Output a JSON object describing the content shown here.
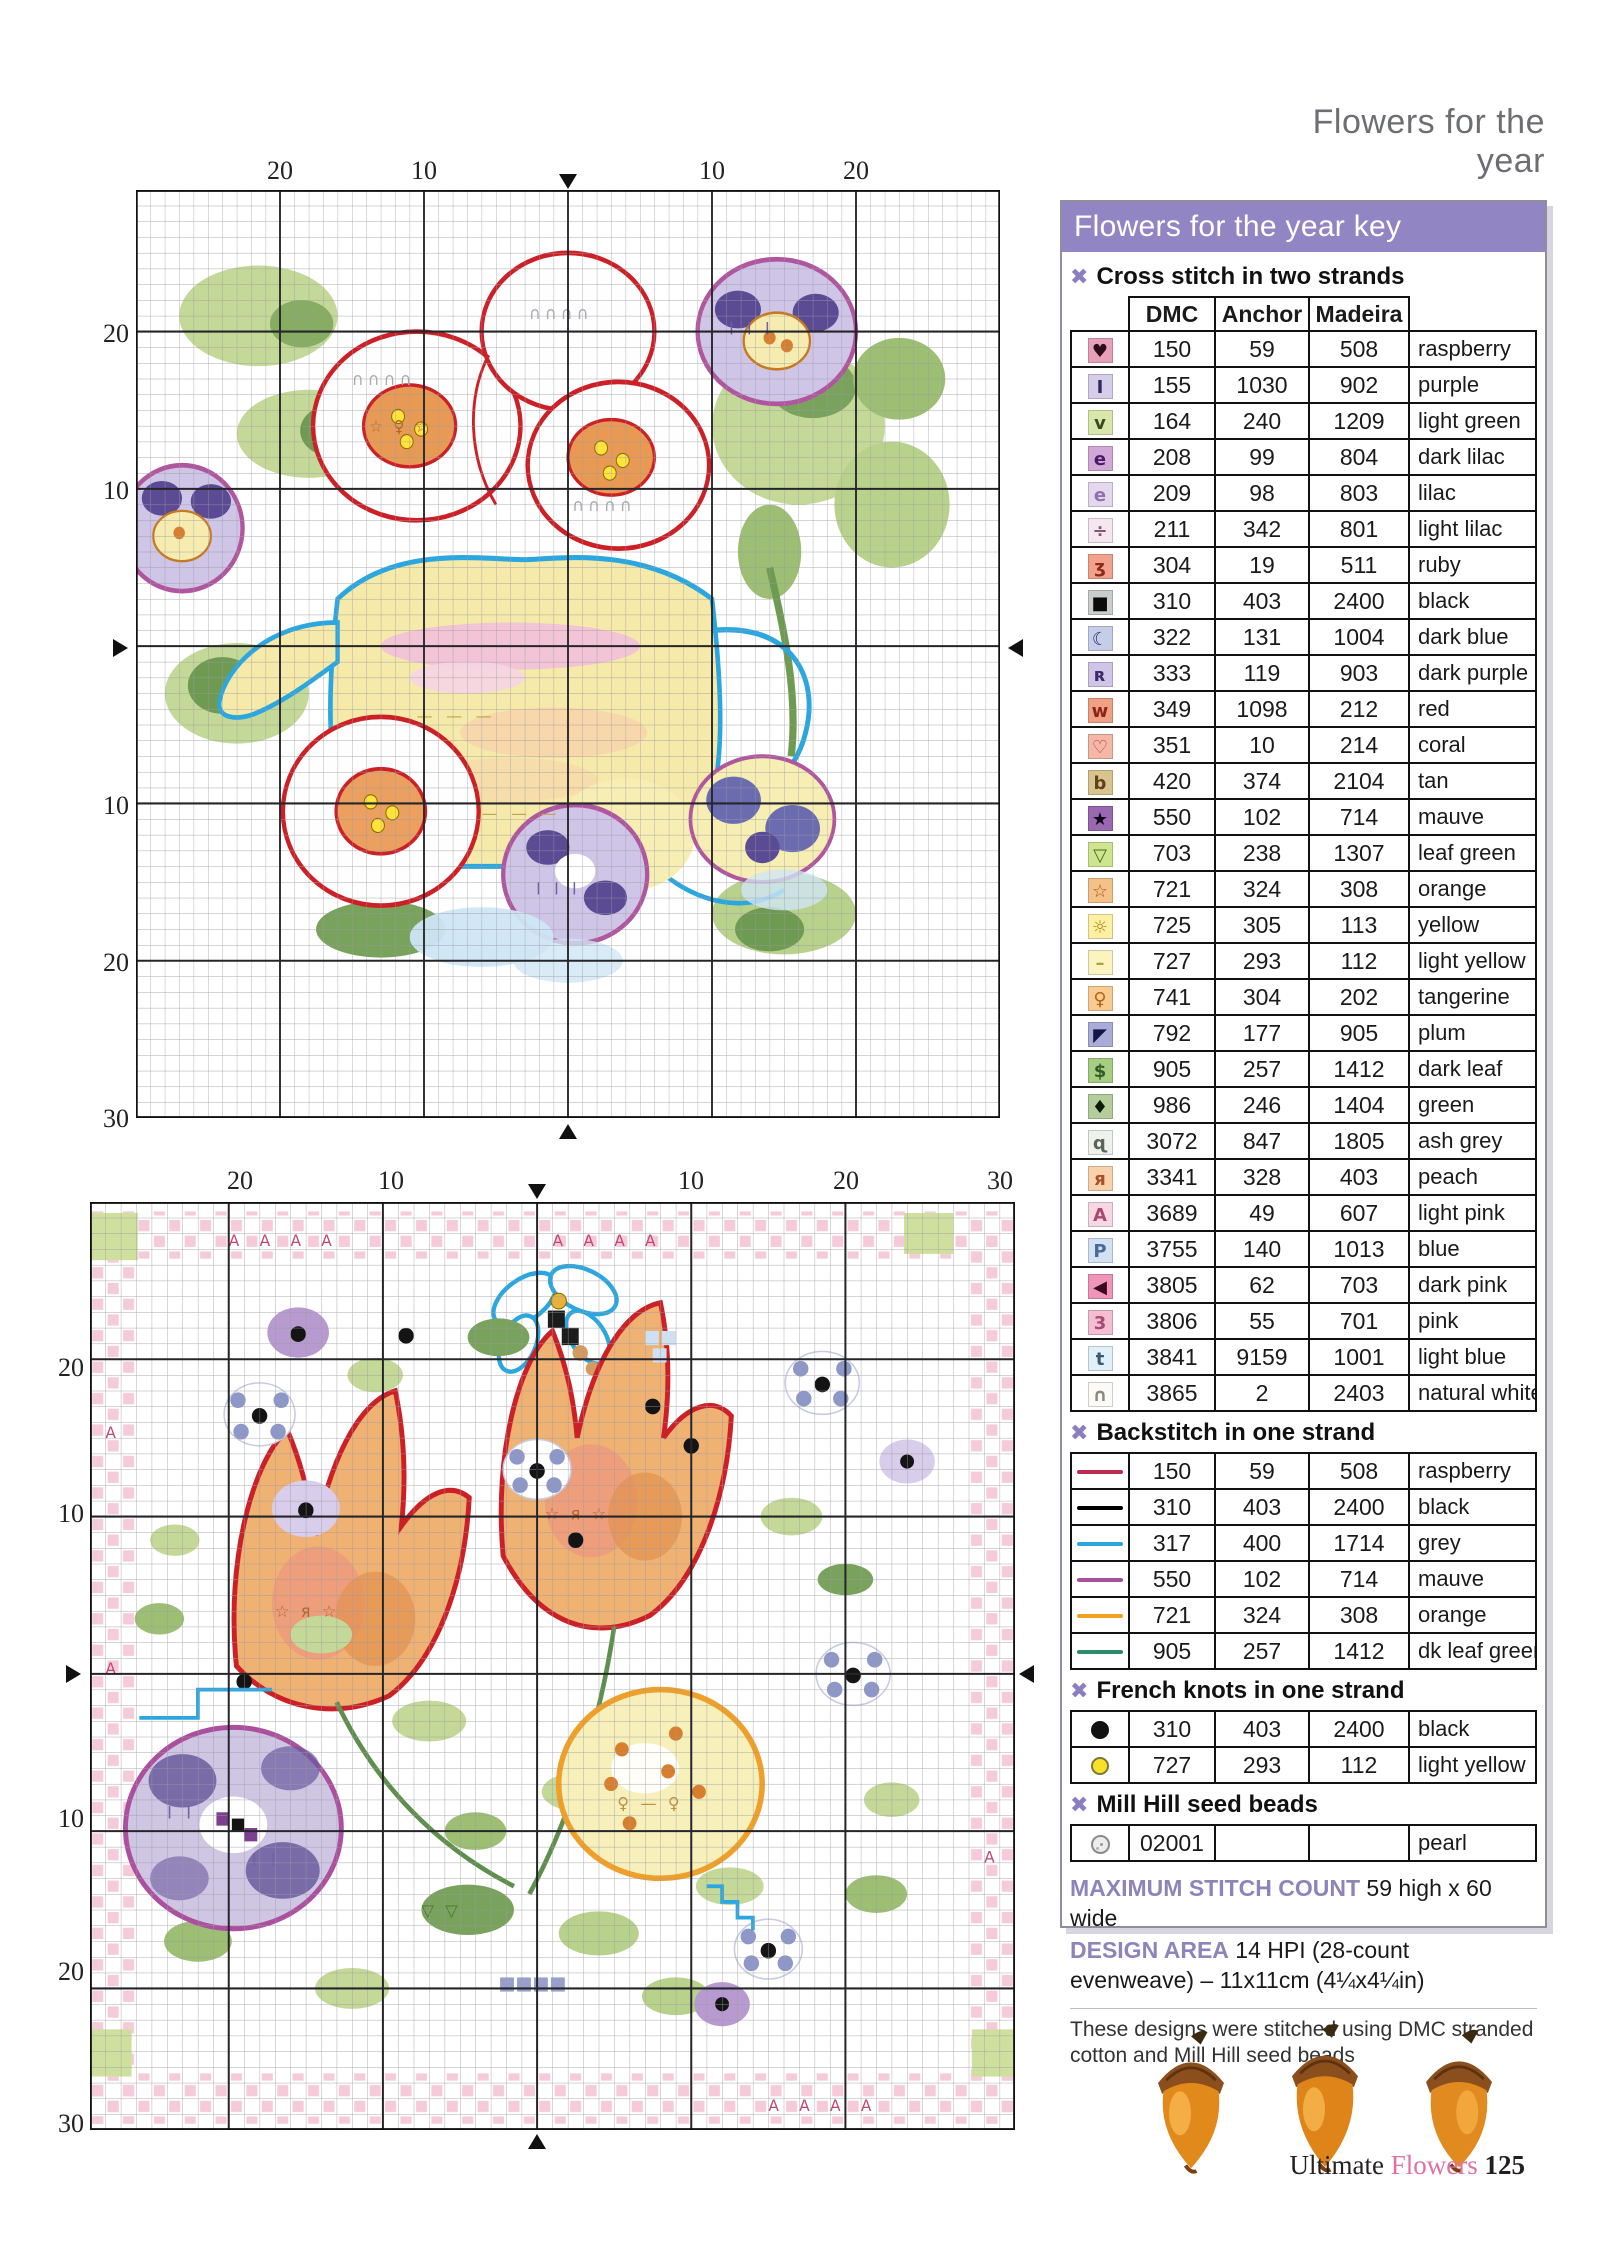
{
  "page": {
    "header": "Flowers for the year",
    "footer": {
      "brand": "Ultimate",
      "brand2": "Flowers",
      "page_number": "125"
    }
  },
  "charts": [
    {
      "name": "Teapot bouquet cross stitch chart",
      "top_labels": [
        "20",
        "10",
        "10",
        "20"
      ],
      "left_labels": [
        "20",
        "10",
        "10",
        "20",
        "30"
      ],
      "tex": {
        "white": "∩∩∩∩",
        "yellow": "— — —",
        "lilac": "I I I",
        "orange": "☆ ♀ ☆"
      }
    },
    {
      "name": "Tulip wreath cross stitch chart",
      "top_labels": [
        "20",
        "10",
        "10",
        "20",
        "30"
      ],
      "left_labels": [
        "20",
        "10",
        "10",
        "20",
        "30"
      ],
      "tex": {
        "borderA": "A   A   A   A",
        "singleA": "A",
        "lilac": "I I",
        "orange": "☆ я ☆",
        "yellow": "♀ — ♀",
        "green": "▽ ▽"
      }
    }
  ],
  "key": {
    "title": "Flowers for the year key",
    "sections": {
      "cross": {
        "label": "Cross stitch in two strands",
        "columns": [
          "DMC",
          "Anchor",
          "Madeira"
        ],
        "rows": [
          {
            "sym": "♥",
            "bg": "#e8a0b8",
            "fg": "#2a0d18",
            "dmc": "150",
            "anchor": "59",
            "madeira": "508",
            "name": "raspberry"
          },
          {
            "sym": "I",
            "bg": "#d6cdeb",
            "fg": "#2c2a5e",
            "dmc": "155",
            "anchor": "1030",
            "madeira": "902",
            "name": "purple"
          },
          {
            "sym": "v",
            "bg": "#d9e7ab",
            "fg": "#3a4a1e",
            "dmc": "164",
            "anchor": "240",
            "madeira": "1209",
            "name": "light green"
          },
          {
            "sym": "e",
            "bg": "#d2a8d8",
            "fg": "#4c1a64",
            "dmc": "208",
            "anchor": "99",
            "madeira": "804",
            "name": "dark lilac"
          },
          {
            "sym": "e",
            "bg": "#e4d7ee",
            "fg": "#8f6fae",
            "dmc": "209",
            "anchor": "98",
            "madeira": "803",
            "name": "lilac"
          },
          {
            "sym": "÷",
            "bg": "#f5e6f0",
            "fg": "#7c5a74",
            "dmc": "211",
            "anchor": "342",
            "madeira": "801",
            "name": "light lilac"
          },
          {
            "sym": "ʒ",
            "bg": "#f2a28c",
            "fg": "#8c2a1e",
            "dmc": "304",
            "anchor": "19",
            "madeira": "511",
            "name": "ruby"
          },
          {
            "sym": "■",
            "bg": "#cbcccc",
            "fg": "#0a0a0a",
            "dmc": "310",
            "anchor": "403",
            "madeira": "2400",
            "name": "black"
          },
          {
            "sym": "☾",
            "bg": "#c6cde9",
            "fg": "#23306e",
            "dmc": "322",
            "anchor": "131",
            "madeira": "1004",
            "name": "dark blue"
          },
          {
            "sym": "ʀ",
            "bg": "#d0c5e8",
            "fg": "#3a2a6e",
            "dmc": "333",
            "anchor": "119",
            "madeira": "903",
            "name": "dark purple"
          },
          {
            "sym": "w",
            "bg": "#f0a184",
            "fg": "#8c2418",
            "dmc": "349",
            "anchor": "1098",
            "madeira": "212",
            "name": "red"
          },
          {
            "sym": "♡",
            "bg": "#f5b8a8",
            "fg": "#b43a28",
            "dmc": "351",
            "anchor": "10",
            "madeira": "214",
            "name": "coral"
          },
          {
            "sym": "b",
            "bg": "#d9c48e",
            "fg": "#5e431a",
            "dmc": "420",
            "anchor": "374",
            "madeira": "2104",
            "name": "tan"
          },
          {
            "sym": "★",
            "bg": "#9a68b0",
            "fg": "#14061c",
            "dmc": "550",
            "anchor": "102",
            "madeira": "714",
            "name": "mauve"
          },
          {
            "sym": "▽",
            "bg": "#cfe48f",
            "fg": "#3f6d1f",
            "dmc": "703",
            "anchor": "238",
            "madeira": "1307",
            "name": "leaf green"
          },
          {
            "sym": "☆",
            "bg": "#f6c189",
            "fg": "#a05c14",
            "dmc": "721",
            "anchor": "324",
            "madeira": "308",
            "name": "orange"
          },
          {
            "sym": "☼",
            "bg": "#fdf0a2",
            "fg": "#b08818",
            "dmc": "725",
            "anchor": "305",
            "madeira": "113",
            "name": "yellow"
          },
          {
            "sym": "–",
            "bg": "#fbf4c0",
            "fg": "#b0a040",
            "dmc": "727",
            "anchor": "293",
            "madeira": "112",
            "name": "light yellow"
          },
          {
            "sym": "♀",
            "bg": "#f9cb90",
            "fg": "#b06414",
            "dmc": "741",
            "anchor": "304",
            "madeira": "202",
            "name": "tangerine"
          },
          {
            "sym": "◤",
            "bg": "#a9abd9",
            "fg": "#101848",
            "dmc": "792",
            "anchor": "177",
            "madeira": "905",
            "name": "plum"
          },
          {
            "sym": "$",
            "bg": "#a7cd83",
            "fg": "#2f5c24",
            "dmc": "905",
            "anchor": "257",
            "madeira": "1412",
            "name": "dark leaf"
          },
          {
            "sym": "♦",
            "bg": "#b3cd9d",
            "fg": "#0c1c08",
            "dmc": "986",
            "anchor": "246",
            "madeira": "1404",
            "name": "green"
          },
          {
            "sym": "ɋ",
            "bg": "#eef1ec",
            "fg": "#5a625a",
            "dmc": "3072",
            "anchor": "847",
            "madeira": "1805",
            "name": "ash grey"
          },
          {
            "sym": "я",
            "bg": "#f9d2ab",
            "fg": "#a8502c",
            "dmc": "3341",
            "anchor": "328",
            "madeira": "403",
            "name": "peach"
          },
          {
            "sym": "A",
            "bg": "#f7d7e4",
            "fg": "#a84a70",
            "dmc": "3689",
            "anchor": "49",
            "madeira": "607",
            "name": "light pink"
          },
          {
            "sym": "P",
            "bg": "#d2e1f3",
            "fg": "#4a6a96",
            "dmc": "3755",
            "anchor": "140",
            "madeira": "1013",
            "name": "blue"
          },
          {
            "sym": "◀",
            "bg": "#f094ba",
            "fg": "#3c0a20",
            "dmc": "3805",
            "anchor": "62",
            "madeira": "703",
            "name": "dark pink"
          },
          {
            "sym": "3",
            "bg": "#f5bdd2",
            "fg": "#a44a74",
            "dmc": "3806",
            "anchor": "55",
            "madeira": "701",
            "name": "pink"
          },
          {
            "sym": "t",
            "bg": "#e0eff8",
            "fg": "#3a5a72",
            "dmc": "3841",
            "anchor": "9159",
            "madeira": "1001",
            "name": "light blue"
          },
          {
            "sym": "∩",
            "bg": "#fbfaf6",
            "fg": "#8a8a82",
            "dmc": "3865",
            "anchor": "2",
            "madeira": "2403",
            "name": "natural white"
          }
        ]
      },
      "backstitch": {
        "label": "Backstitch in one strand",
        "rows": [
          {
            "line": "#c22950",
            "dmc": "150",
            "anchor": "59",
            "madeira": "508",
            "name": "raspberry"
          },
          {
            "line": "#000000",
            "dmc": "310",
            "anchor": "403",
            "madeira": "2400",
            "name": "black"
          },
          {
            "line": "#2ba6de",
            "dmc": "317",
            "anchor": "400",
            "madeira": "1714",
            "name": "grey"
          },
          {
            "line": "#a4509b",
            "dmc": "550",
            "anchor": "102",
            "madeira": "714",
            "name": "mauve"
          },
          {
            "line": "#f5a01e",
            "dmc": "721",
            "anchor": "324",
            "madeira": "308",
            "name": "orange"
          },
          {
            "line": "#2e8b6e",
            "dmc": "905",
            "anchor": "257",
            "madeira": "1412",
            "name": "dk leaf green"
          }
        ]
      },
      "french": {
        "label": "French knots in one strand",
        "rows": [
          {
            "color": "#111111",
            "ring": "#111111",
            "dmc": "310",
            "anchor": "403",
            "madeira": "2400",
            "name": "black"
          },
          {
            "color": "#f8e229",
            "ring": "#7a7a38",
            "dmc": "727",
            "anchor": "293",
            "madeira": "112",
            "name": "light yellow"
          }
        ]
      },
      "beads": {
        "label": "Mill Hill seed beads",
        "rows": [
          {
            "code": "02001",
            "anchor": "",
            "madeira": "",
            "name": "pearl"
          }
        ]
      }
    },
    "stats": {
      "max_label": "MAXIMUM STITCH COUNT",
      "max_value": "59 high x 60 wide",
      "area_label": "DESIGN AREA",
      "area_value": "14 HPI (28-count evenweave) – 11x11cm (4¼x4¼in)",
      "note": "These designs were stitched using DMC stranded cotton and Mill Hill seed beads"
    }
  }
}
